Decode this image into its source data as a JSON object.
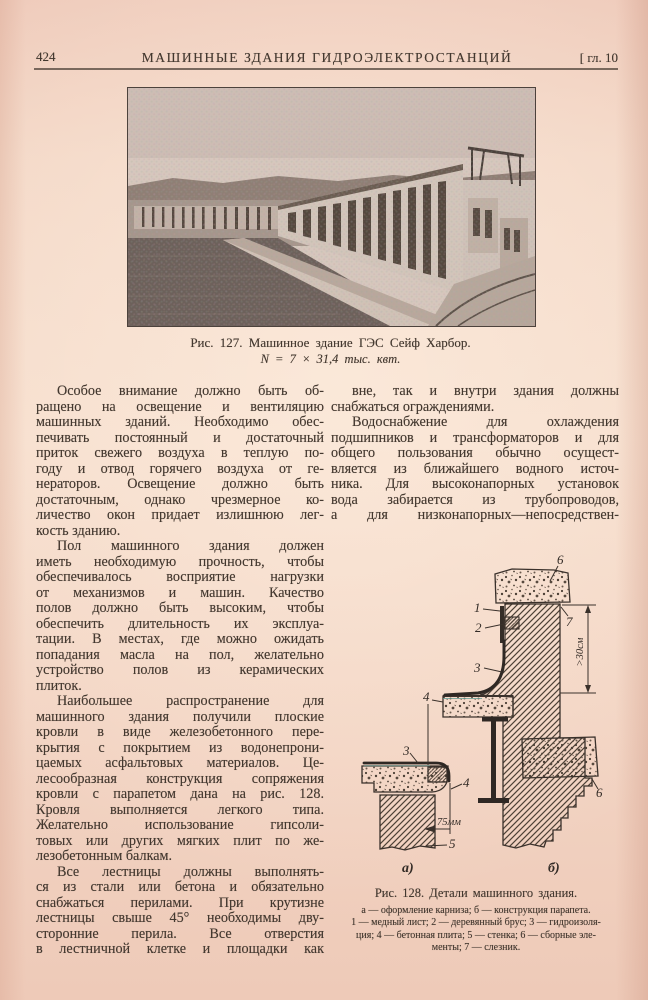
{
  "header": {
    "page_number": "424",
    "title": "МАШИННЫЕ ЗДАНИЯ ГИДРОЭЛЕКТРОСТАНЦИЙ",
    "chapter": "[ гл. 10"
  },
  "figure127": {
    "caption_line1": "Рис. 127. Машинное здание ГЭС Сейф Харбор.",
    "caption_line2": "N = 7 × 31,4 тыс. квт."
  },
  "columns": {
    "left": [
      {
        "justify_last": false,
        "lines": [
          "Особое внимание должно быть об-",
          "ращено на освещение и вентиляцию",
          "машинных зданий. Необходимо обес-",
          "печивать постоянный и достаточный",
          "приток свежего воздуха в теплую по-",
          "году и отвод горячего воздуха от ге-",
          "нераторов. Освещение должно быть",
          "достаточным, однако чрезмерное ко-",
          "личество окон придает излишнюю лег-",
          "кость зданию."
        ]
      },
      {
        "justify_last": false,
        "lines": [
          "Пол машинного здания должен",
          "иметь необходимую прочность, чтобы",
          "обеспечивалось восприятие нагрузки",
          "от механизмов и машин. Качество",
          "полов должно быть высоким, чтобы",
          "обеспечить длительность их эксплуа-",
          "тации. В местах, где можно ожидать",
          "попадания масла на пол, желательно",
          "устройство полов из керамических",
          "плиток."
        ]
      },
      {
        "justify_last": false,
        "lines": [
          "Наибольшее распространение для",
          "машинного здания получили плоские",
          "кровли в виде железобетонного пере-",
          "крытия с покрытием из водонепрони-",
          "цаемых асфальтовых материалов. Це-",
          "лесообразная конструкция сопряжения",
          "кровли с парапетом дана на рис. 128.",
          "Кровля выполняется легкого типа.",
          "Желательно использование гипсоли-",
          "товых или других мягких плит по же-",
          "лезобетонным балкам."
        ]
      },
      {
        "justify_last": true,
        "lines": [
          "Все лестницы должны выполнять-",
          "ся из стали или бетона и обязательно",
          "снабжаться перилами. При крутизне",
          "лестницы свыше 45° необходимы дву-",
          "сторонние перила. Все отверстия",
          "в лестничной клетке и площадки как"
        ]
      }
    ],
    "right": [
      {
        "justify_last": false,
        "lines": [
          "вне, так и внутри здания должны",
          "снабжаться ограждениями."
        ]
      },
      {
        "justify_last": true,
        "lines": [
          "Водоснабжение для охлаждения",
          "подшипников и трансформаторов и для",
          "общего пользования обычно осущест-",
          "вляется из ближайшего водного источ-",
          "ника. Для высоконапорных установок",
          "вода забирается из трубопроводов,",
          "а для низконапорных—непосредствен-"
        ]
      }
    ]
  },
  "figure128": {
    "labels": {
      "l1": "1",
      "l2": "2",
      "l3": "3",
      "l4": "4",
      "l5": "5",
      "l6": "6",
      "l7": "7",
      "a": "а)",
      "b": "б)",
      "dim_a": "75мм",
      "dim_b": ">30см"
    },
    "caption": "Рис. 128. Детали машинного здания.",
    "legend": [
      "а — оформление карниза; б — конструкция парапета.",
      "1 — медный лист; 2 — деревянный брус; 3 — гидроизоля-",
      "ция; 4 — бетонная плита; 5 — стенка; 6 — сборные эле-",
      "менты; 7 — слезник."
    ]
  },
  "colors": {
    "paper": "#f3d6c4",
    "ink": "#43382f"
  }
}
